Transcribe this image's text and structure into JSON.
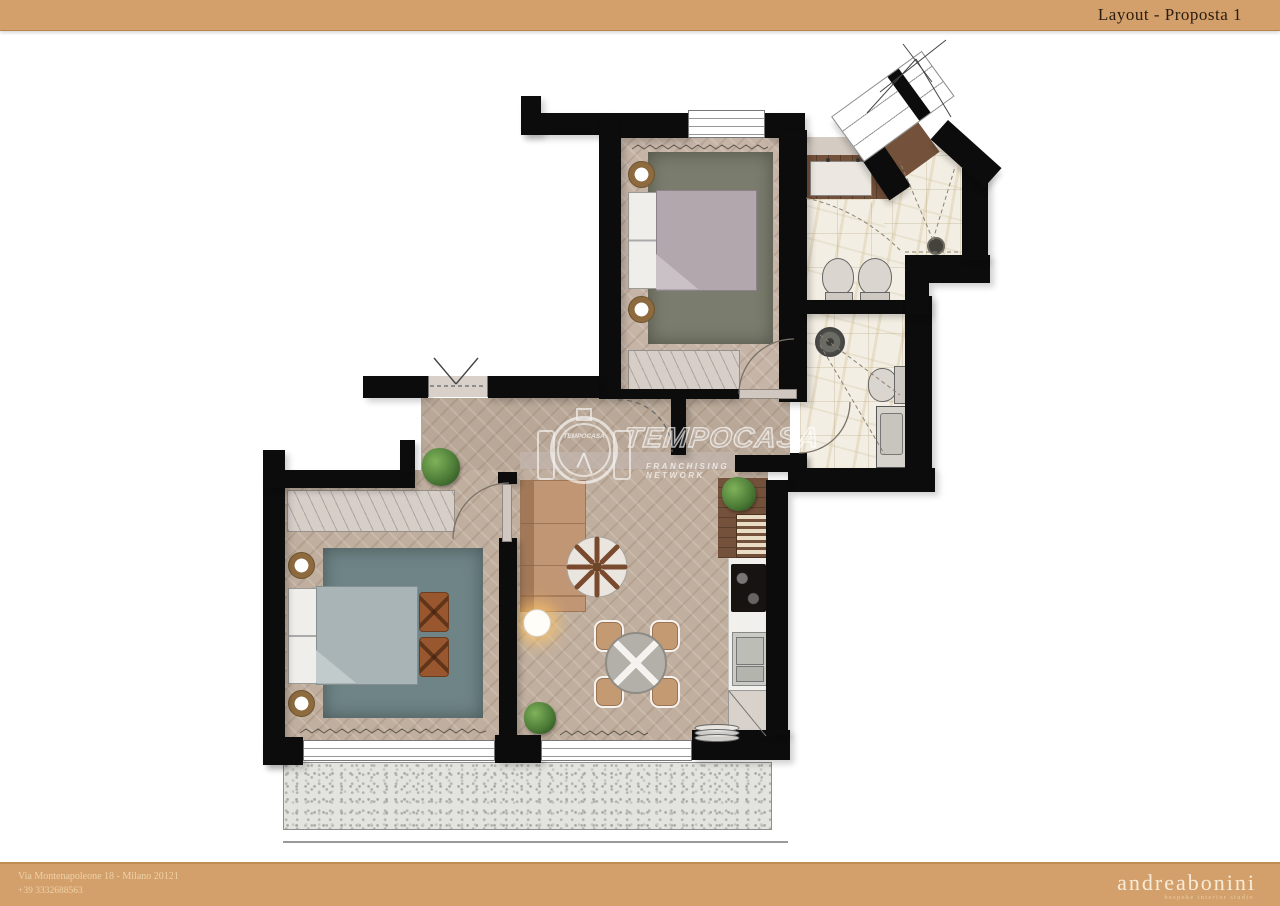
{
  "header": {
    "title": "Layout - Proposta 1"
  },
  "watermark": {
    "logo_text": "TEMPOCASA",
    "brand": "TEMPOCASA",
    "subtitle": "FRANCHISING NETWORK"
  },
  "footer": {
    "address": "Via Montenapoleone 18 - Milano 20121",
    "phone": "+39 3332688563",
    "brand": "andreabonini",
    "tagline": "bespoke interior studio"
  },
  "colors": {
    "band_bg": "#d3a06c",
    "band_text_dark": "#2a1c0e",
    "band_text_light": "#eed2a6",
    "wall": "#0c0c0c",
    "wood_floor": "#bdab9c",
    "marble_floor": "#f3eee3",
    "rug_sage": "#7a7c6d",
    "rug_teal": "#6e8486",
    "sofa": "#c09674",
    "leather_ottoman": "#99572f",
    "kitchen_wood": "#74513a",
    "balcony_gravel": "#e3e3df",
    "plant_green": "#4e7d38"
  }
}
